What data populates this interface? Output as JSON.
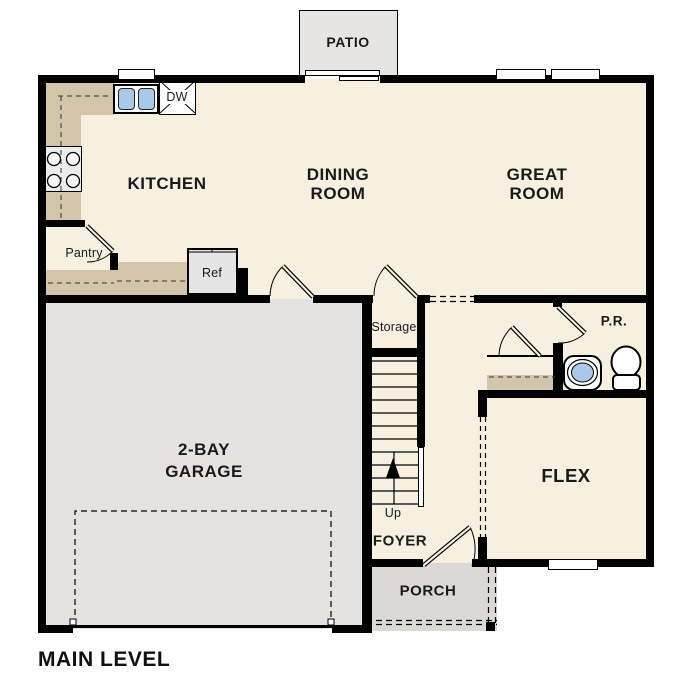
{
  "plan": {
    "title": "MAIN LEVEL",
    "rooms": {
      "patio": "PATIO",
      "kitchen": "KITCHEN",
      "dining_line1": "DINING",
      "dining_line2": "ROOM",
      "great_line1": "GREAT",
      "great_line2": "ROOM",
      "garage_line1": "2-BAY",
      "garage_line2": "GARAGE",
      "storage": "Storage",
      "pantry": "Pantry",
      "foyer": "FOYER",
      "porch": "PORCH",
      "flex": "FLEX",
      "powder_room": "P.R."
    },
    "fixtures": {
      "dishwasher": "DW",
      "refrigerator": "Ref",
      "stairs_direction": "Up"
    },
    "colors": {
      "wall": "#000000",
      "interior_floor": "#f7efe0",
      "garage_floor": "#e5e3e1",
      "porch_floor": "#dbd9d6",
      "patio_floor": "#e7e5e3",
      "counter": "#d2c5a9",
      "sink_blue": "#aac9e9",
      "appliance_gray": "#e9e9e9"
    }
  }
}
